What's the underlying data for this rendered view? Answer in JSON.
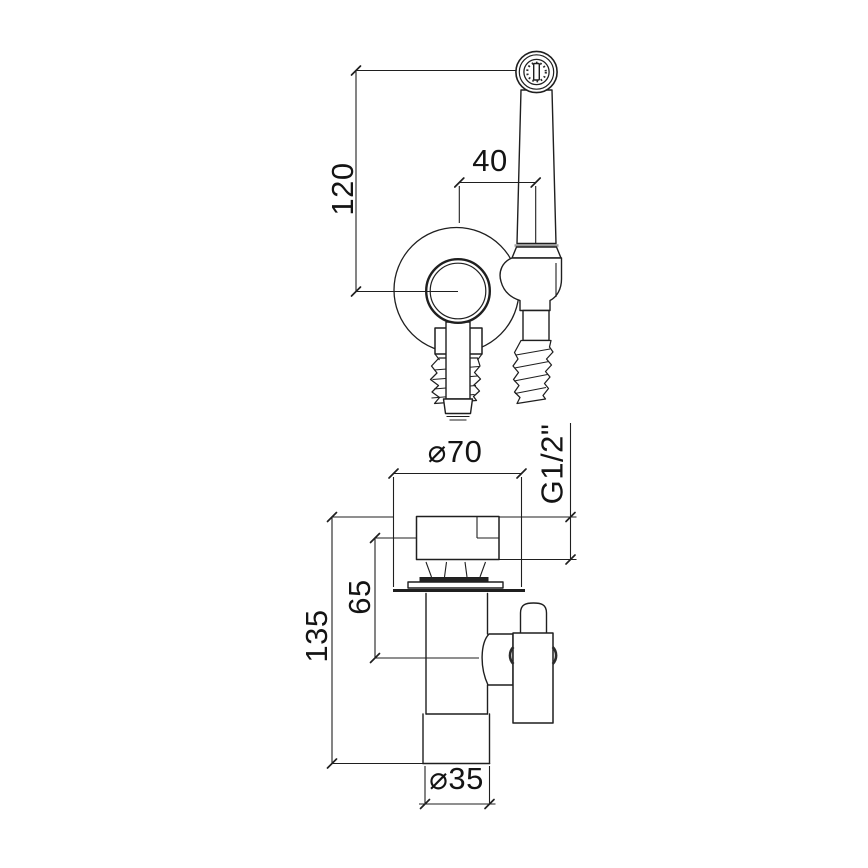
{
  "drawing": {
    "type": "technical-dimension-drawing",
    "subject": "wall-mounted bidet hand spray set, front and side projection",
    "background_color": "#ffffff",
    "line_color": "#1f1f1f",
    "joint_gray_color": "#9a9a9a",
    "front_view": {
      "dim_vertical": "120",
      "dim_horizontal": "40"
    },
    "side_view": {
      "dim_escutcheon_diameter": "⌀70",
      "dim_thread": "G1/2\"",
      "dim_upper_length": "65",
      "dim_total_length": "135",
      "dim_pipe_diameter": "⌀35"
    }
  }
}
